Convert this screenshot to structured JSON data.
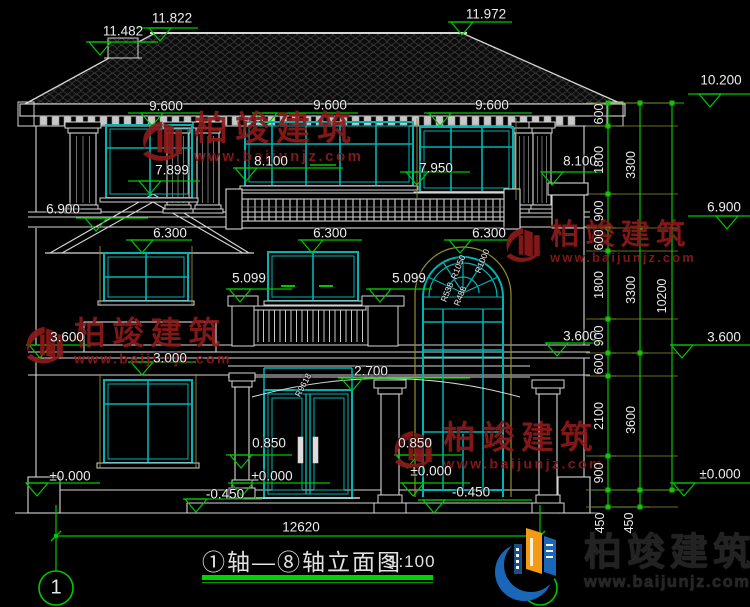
{
  "drawing": {
    "title": "①轴—⑧轴立面图",
    "scale": "1:100",
    "axis_start": "1",
    "axis_end": "8"
  },
  "watermark": {
    "name": "柏竣建筑",
    "url": "www.baijunjz.com"
  },
  "logo": {
    "name": "柏竣建筑",
    "url": "www.baijunjz.com"
  },
  "colors": {
    "line_white": "#d6d6d6",
    "window_teal": "#00b4b4",
    "dimension_green": "#00c800",
    "extension_yellow": "#8f8f32",
    "watermark_red": "#8c1a1a",
    "logo_blue": "#1a66b8",
    "logo_orange": "#f49b15"
  },
  "levels": [
    {
      "t": "11.482",
      "x": 123,
      "y": 31
    },
    {
      "t": "11.822",
      "x": 172,
      "y": 18
    },
    {
      "t": "11.972",
      "x": 486,
      "y": 14
    },
    {
      "t": "9.600",
      "x": 166,
      "y": 106
    },
    {
      "t": "9.600",
      "x": 330,
      "y": 105
    },
    {
      "t": "9.600",
      "x": 492,
      "y": 105
    },
    {
      "t": "8.100",
      "x": 271,
      "y": 161
    },
    {
      "t": "8.100",
      "x": 580,
      "y": 161
    },
    {
      "t": "7.899",
      "x": 172,
      "y": 170
    },
    {
      "t": "7.950",
      "x": 436,
      "y": 168
    },
    {
      "t": "6.900",
      "x": 63,
      "y": 209
    },
    {
      "t": "6.900",
      "x": 724,
      "y": 207
    },
    {
      "t": "10.200",
      "x": 721,
      "y": 80
    },
    {
      "t": "6.300",
      "x": 170,
      "y": 233
    },
    {
      "t": "6.300",
      "x": 330,
      "y": 233
    },
    {
      "t": "6.300",
      "x": 489,
      "y": 233
    },
    {
      "t": "5.099",
      "x": 249,
      "y": 278
    },
    {
      "t": "5.099",
      "x": 409,
      "y": 278
    },
    {
      "t": "3.600",
      "x": 67,
      "y": 337
    },
    {
      "t": "3.600",
      "x": 580,
      "y": 336
    },
    {
      "t": "3.600",
      "x": 724,
      "y": 337
    },
    {
      "t": "3.000",
      "x": 170,
      "y": 358
    },
    {
      "t": "2.700",
      "x": 371,
      "y": 371
    },
    {
      "t": "0.850",
      "x": 269,
      "y": 443
    },
    {
      "t": "0.850",
      "x": 415,
      "y": 443
    },
    {
      "t": "±0.000",
      "x": 70,
      "y": 476
    },
    {
      "t": "±0.000",
      "x": 272,
      "y": 476
    },
    {
      "t": "±0.000",
      "x": 431,
      "y": 471
    },
    {
      "t": "±0.000",
      "x": 720,
      "y": 474
    },
    {
      "t": "-0.450",
      "x": 225,
      "y": 494
    },
    {
      "t": "-0.450",
      "x": 471,
      "y": 492
    },
    {
      "t": "12620",
      "x": 301,
      "y": 527
    }
  ],
  "vdims": [
    {
      "t": "600",
      "x": 599,
      "y": 114,
      "r": -90
    },
    {
      "t": "1800",
      "x": 599,
      "y": 160,
      "r": -90
    },
    {
      "t": "900",
      "x": 599,
      "y": 211,
      "r": -90
    },
    {
      "t": "600",
      "x": 599,
      "y": 240,
      "r": -90
    },
    {
      "t": "1800",
      "x": 599,
      "y": 285,
      "r": -90
    },
    {
      "t": "900",
      "x": 599,
      "y": 336,
      "r": -90
    },
    {
      "t": "600",
      "x": 599,
      "y": 364,
      "r": -90
    },
    {
      "t": "2100",
      "x": 599,
      "y": 416,
      "r": -90
    },
    {
      "t": "900",
      "x": 599,
      "y": 473,
      "r": -90
    },
    {
      "t": "450",
      "x": 600,
      "y": 523,
      "r": -90
    },
    {
      "t": "3300",
      "x": 631,
      "y": 165,
      "r": -90
    },
    {
      "t": "3300",
      "x": 631,
      "y": 290,
      "r": -90
    },
    {
      "t": "3600",
      "x": 631,
      "y": 420,
      "r": -90
    },
    {
      "t": "450",
      "x": 629,
      "y": 523,
      "r": -90
    },
    {
      "t": "10200",
      "x": 662,
      "y": 296,
      "r": -90
    }
  ],
  "radius_labels": [
    {
      "t": "R1050",
      "x": 458,
      "y": 267,
      "r": -68
    },
    {
      "t": "R1000",
      "x": 482,
      "y": 261,
      "r": -68
    },
    {
      "t": "R538",
      "x": 447,
      "y": 292,
      "r": -68
    },
    {
      "t": "R488",
      "x": 460,
      "y": 296,
      "r": -68
    },
    {
      "t": "R9618",
      "x": 303,
      "y": 385,
      "r": -62
    }
  ]
}
